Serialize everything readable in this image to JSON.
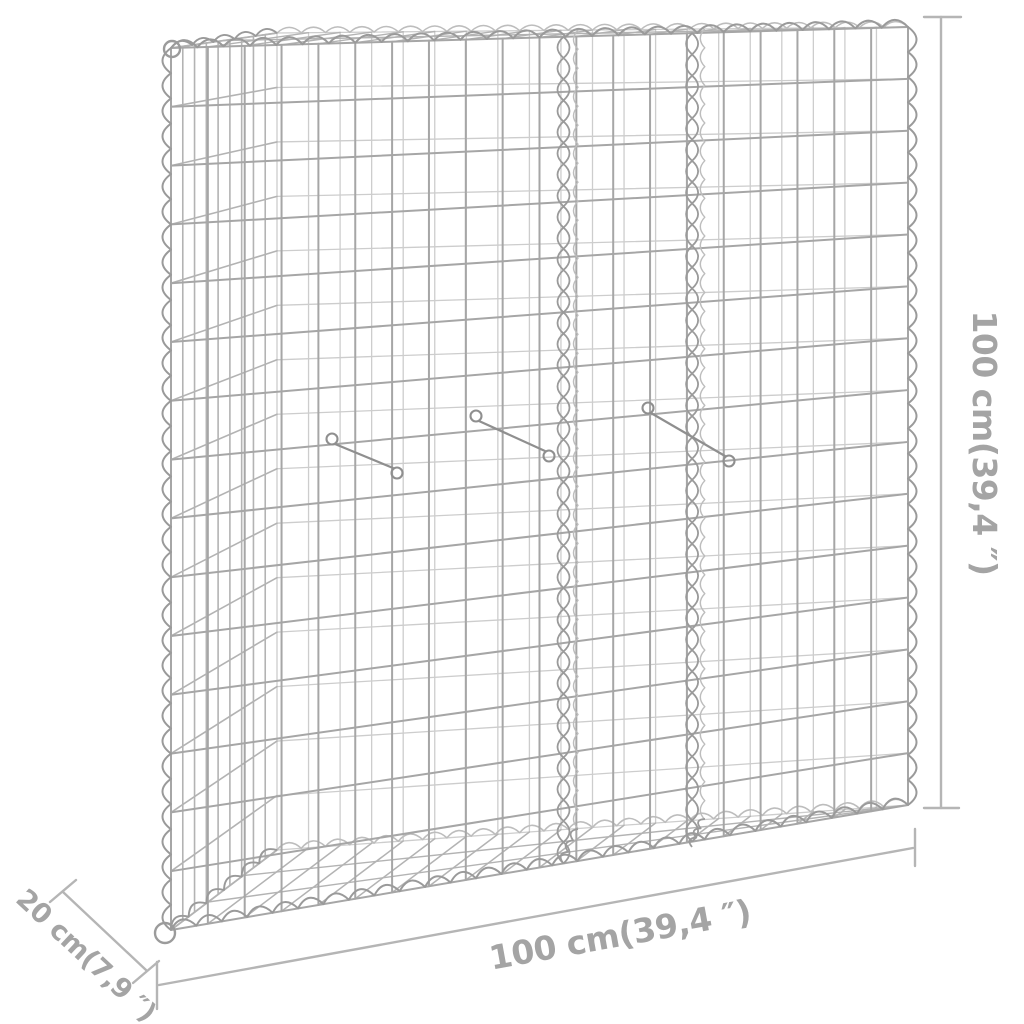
{
  "scene": {
    "background": "#ffffff",
    "subject": "Galvanized steel gabion wire-mesh basket (raised bed) shown in perspective with dimension annotations",
    "finish": "galvanized silver"
  },
  "dimensions": {
    "height_label": "100 cm(39,4 ″)",
    "width_label": "100 cm(39,4 ″)",
    "depth_label": "20 cm(7,9 ″)"
  },
  "colors": {
    "background": "#ffffff",
    "wire_front": "#a6a6a6",
    "wire_back": "#cdcdcd",
    "wire_mid": "#b3b3b3",
    "coil": "#9a9a9a",
    "coil_light": "#bdbdbd",
    "hook": "#8f8f8f",
    "ring": "#9b9b9b",
    "dimension_line": "#b5b5b5",
    "dimension_text": "#a4a4a4"
  }
}
